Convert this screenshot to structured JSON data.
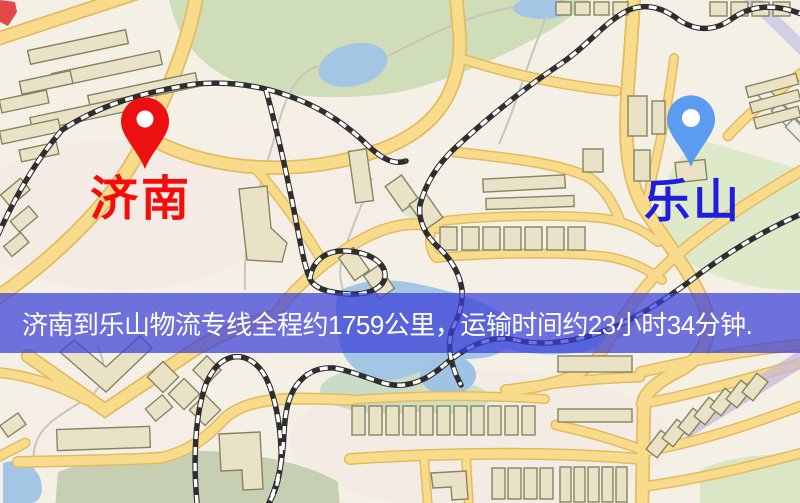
{
  "map": {
    "origin": {
      "label": "济南",
      "marker_color": "#ee1010",
      "label_color": "#f50d0d"
    },
    "destination": {
      "label": "乐山",
      "marker_color": "#5b9bf0",
      "label_color": "#1e1ede"
    },
    "banner": {
      "text": "济南到乐山物流专线全程约1759公里，运输时间约23小时34分钟.",
      "background_color": "#3a3ed8",
      "text_color": "#ffffff"
    },
    "route": {
      "origin_city": "济南",
      "destination_city": "乐山",
      "distance_km": "1759",
      "duration": "23小时34分钟"
    }
  }
}
